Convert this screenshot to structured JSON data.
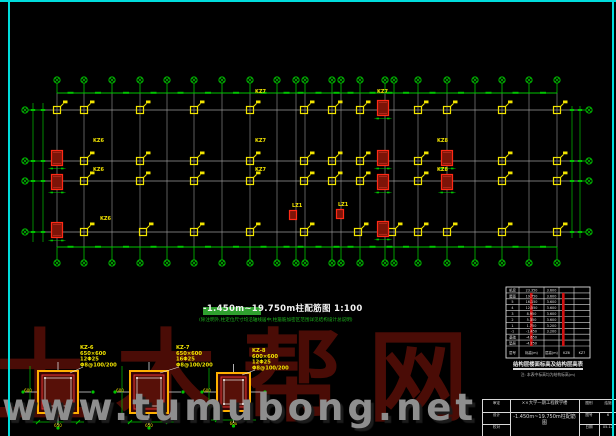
{
  "frame": {
    "border_color": "#00dcdc"
  },
  "watermark": {
    "logo_text": "土木帮网",
    "url_text": "www.tumubong.net",
    "logo_color": "#4a0c06",
    "url_color": "#8e8e8e"
  },
  "title": {
    "text": "-1.450m~19.750m柱配筋图  1:100",
    "note": "(除注明外,柱定位尺寸均沿轴线居中;柱箍筋加密区范围详见结构设计总说明)"
  },
  "plan": {
    "geometry": {
      "bubble_top_y": 80,
      "bubble_bottom_y": 263,
      "bubble_left_x": 25,
      "bubble_right_x": 589,
      "plan_top": 93,
      "plan_bottom": 247,
      "plan_left": 45,
      "plan_right": 582,
      "left_dim_x": [
        33,
        43
      ],
      "right_dim_x": [
        572,
        580
      ]
    },
    "v_axes": [
      57,
      84,
      112,
      140,
      167,
      194,
      222,
      250,
      277,
      296,
      305,
      332,
      341,
      360,
      385,
      394,
      418,
      447,
      475,
      502,
      529,
      557
    ],
    "h_axes": [
      110,
      161,
      181,
      232
    ],
    "yellow_rows": [
      {
        "y": 110,
        "xs": [
          57,
          84,
          140,
          194,
          250,
          304,
          332,
          360,
          418,
          447,
          502,
          557
        ]
      },
      {
        "y": 161,
        "xs": [
          84,
          140,
          194,
          250,
          304,
          332,
          360,
          418,
          502,
          557
        ]
      },
      {
        "y": 181,
        "xs": [
          84,
          140,
          194,
          250,
          304,
          332,
          360,
          418,
          502,
          557
        ]
      },
      {
        "y": 232,
        "xs": [
          84,
          143,
          194,
          250,
          304,
          358,
          392,
          418,
          447,
          502,
          557
        ]
      }
    ],
    "red_columns": [
      {
        "x": 57,
        "y": 158
      },
      {
        "x": 57,
        "y": 182
      },
      {
        "x": 57,
        "y": 230
      },
      {
        "x": 383,
        "y": 108
      },
      {
        "x": 383,
        "y": 158
      },
      {
        "x": 383,
        "y": 182
      },
      {
        "x": 383,
        "y": 229
      },
      {
        "x": 447,
        "y": 158
      },
      {
        "x": 447,
        "y": 182
      },
      {
        "x": 293,
        "y": 215,
        "s": 1
      },
      {
        "x": 340,
        "y": 214,
        "s": 1
      }
    ],
    "flags": [
      {
        "x": 93,
        "y": 142,
        "t": "KZ6"
      },
      {
        "x": 93,
        "y": 171,
        "t": "KZ6"
      },
      {
        "x": 100,
        "y": 220,
        "t": "KZ6"
      },
      {
        "x": 255,
        "y": 93,
        "t": "KZ7"
      },
      {
        "x": 255,
        "y": 142,
        "t": "KZ7"
      },
      {
        "x": 255,
        "y": 171,
        "t": "KZ7"
      },
      {
        "x": 377,
        "y": 93,
        "t": "KZ7"
      },
      {
        "x": 437,
        "y": 142,
        "t": "KZ8"
      },
      {
        "x": 437,
        "y": 171,
        "t": "KZ8"
      },
      {
        "x": 292,
        "y": 207,
        "t": "LZ1"
      },
      {
        "x": 338,
        "y": 206,
        "t": "LZ1"
      }
    ]
  },
  "sections": [
    {
      "name": "KZ-6",
      "size": "650×600",
      "lines": [
        "KZ-6",
        "650×600",
        "12Φ25",
        "Φ8@100/200"
      ],
      "x": 38,
      "y": 371,
      "w": 40,
      "h": 42,
      "lx": 80,
      "ly": 344
    },
    {
      "name": "KZ-7",
      "size": "650×600",
      "lines": [
        "KZ-7",
        "650×600",
        "16Φ25",
        "Φ8@100/200"
      ],
      "x": 130,
      "y": 371,
      "w": 38,
      "h": 42,
      "lx": 176,
      "ly": 344
    },
    {
      "name": "KZ-8",
      "size": "600×600",
      "lines": [
        "KZ-8",
        "600×600",
        "12Φ25",
        "Φ8@100/200"
      ],
      "x": 217,
      "y": 373,
      "w": 33,
      "h": 38,
      "lx": 252,
      "ly": 347
    }
  ],
  "schedule": {
    "x": 506,
    "y": 287,
    "w": 84,
    "h": 71,
    "col_edges": [
      0,
      13,
      38,
      53,
      68,
      84
    ],
    "rows": [
      [
        "机房",
        "23.350",
        "3.600"
      ],
      [
        "屋面",
        "19.750",
        "3.600"
      ],
      [
        "5",
        "16.150",
        "3.600"
      ],
      [
        "4",
        "12.550",
        "3.600"
      ],
      [
        "3",
        "8.950",
        "3.600"
      ],
      [
        "2",
        "5.350",
        "3.600"
      ],
      [
        "1",
        "1.750",
        "3.200"
      ],
      [
        "-1",
        "-1.450",
        "3.200"
      ],
      [
        "基础",
        "-4.650",
        ""
      ],
      [
        "垫层",
        "-4.750",
        ""
      ]
    ],
    "header": [
      "层号",
      "标高(m)",
      "层高(m)",
      "KZ6",
      "KZ7"
    ],
    "caption": "结构层楼面标高及结构层高表",
    "note": "注: 本表中标高均为结构标高(m)"
  },
  "titleblock": {
    "project": "××大学一期工程教学楼",
    "drawing": "-1.450m~19.750m柱配筋图",
    "left_rows": [
      "审定",
      "设计",
      "校对"
    ],
    "fields": [
      {
        "label": "图别",
        "value": "结施"
      },
      {
        "label": "图号",
        "value": "6"
      },
      {
        "label": "日期",
        "value": "05.12"
      }
    ]
  }
}
